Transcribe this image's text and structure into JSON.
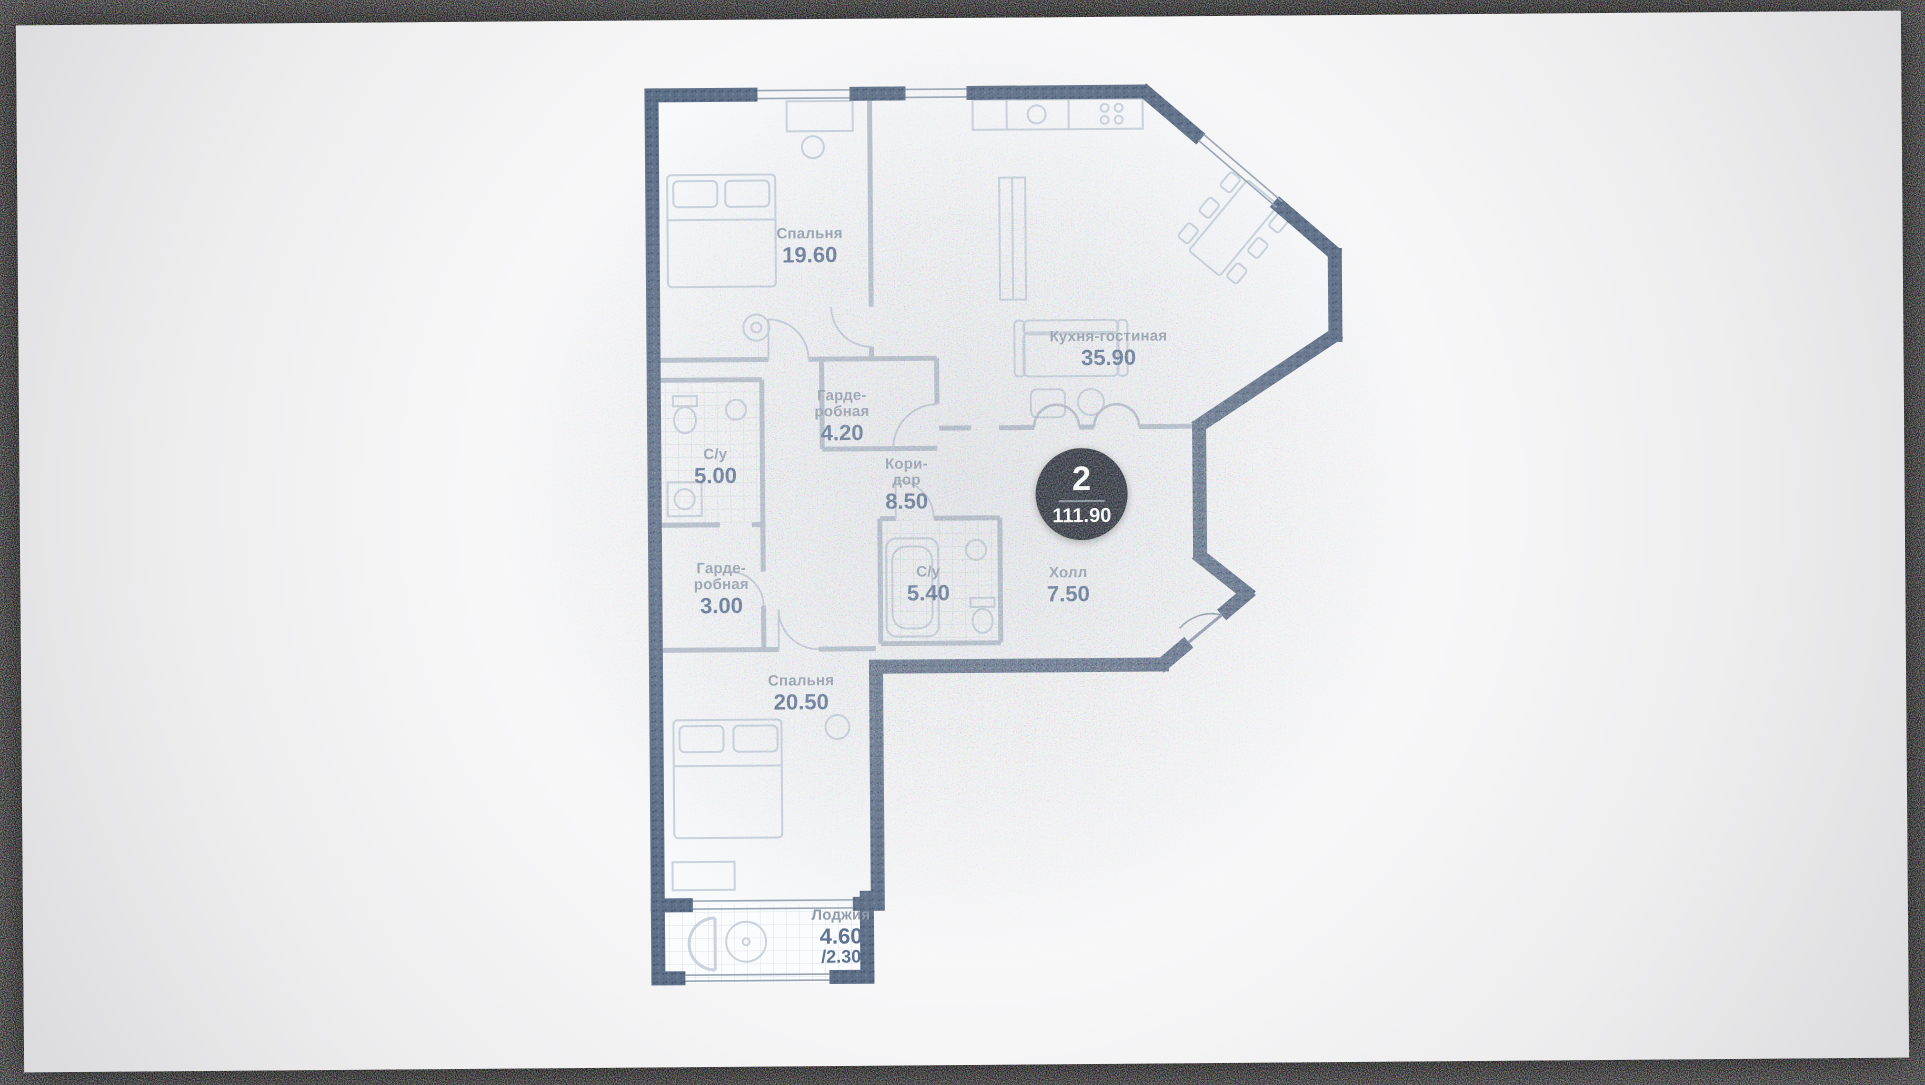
{
  "plan": {
    "badge": {
      "value": "2",
      "total_area": "111.90"
    },
    "rooms": [
      {
        "name": "Спальня",
        "area": "19.60"
      },
      {
        "name": "Кухня-гостиная",
        "area": "35.90"
      },
      {
        "name": "Гарде-\nробная",
        "area": "4.20"
      },
      {
        "name": "С/у",
        "area": "5.00"
      },
      {
        "name": "Кори-\nдор",
        "area": "8.50"
      },
      {
        "name": "Гарде-\nробная",
        "area": "3.00"
      },
      {
        "name": "С/у",
        "area": "5.40"
      },
      {
        "name": "Холл",
        "area": "7.50"
      },
      {
        "name": "Спальня",
        "area": "20.50"
      },
      {
        "name": "Лоджия",
        "area": "4.60",
        "area_secondary": "/2.30"
      }
    ],
    "colors": {
      "wall": "#5f7089",
      "wall_dark": "#47586f",
      "interior_wall": "#b6c0cd",
      "furniture": "#c9d2dd",
      "label_name": "#8f9aa9",
      "label_area": "#5e7292",
      "badge_bg": "#232833",
      "badge_text": "#ffffff"
    }
  }
}
